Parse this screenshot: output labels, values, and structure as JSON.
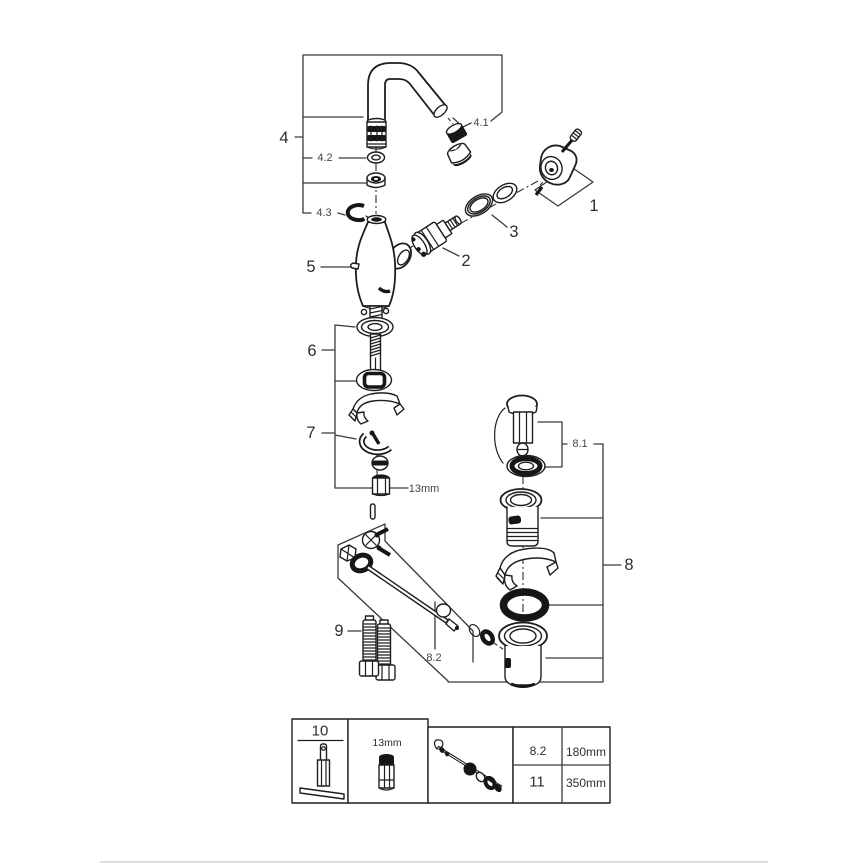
{
  "page": {
    "background": "#ffffff",
    "colors": {
      "line": "#1e1e1e",
      "label": "#2e2e2e",
      "sublabel": "#454545",
      "footer_divider": "#dcdcdc"
    }
  },
  "diagram": {
    "kind": "exploded-parts-diagram",
    "callouts": {
      "n1": "1",
      "n2": "2",
      "n3": "3",
      "n4": "4",
      "n4_1": "4.1",
      "n4_2": "4.2",
      "n4_3": "4.3",
      "n5": "5",
      "n6": "6",
      "n7": "7",
      "n8": "8",
      "n8_1": "8.1",
      "n8_2": "8.2",
      "n9": "9",
      "wrench_size": "13mm"
    },
    "legend_table": {
      "tool_label": "10",
      "socket_label": "13mm",
      "rows": [
        {
          "ref": "8.2",
          "length": "180mm"
        },
        {
          "ref": "11",
          "length": "350mm"
        }
      ]
    }
  }
}
